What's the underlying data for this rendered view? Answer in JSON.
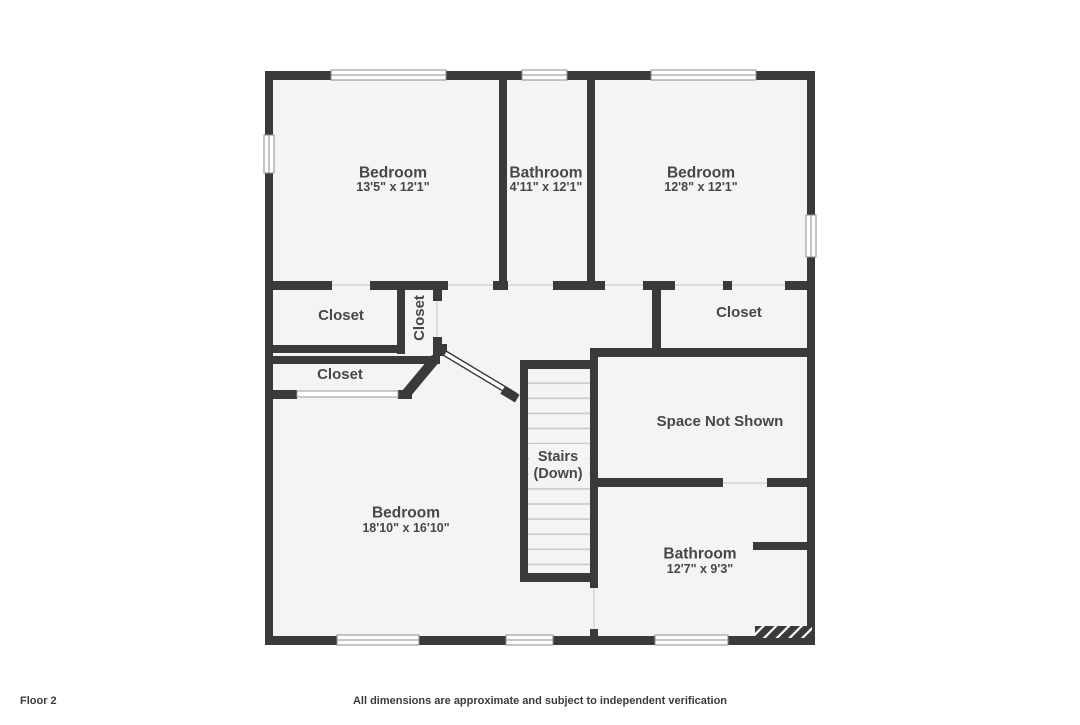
{
  "colors": {
    "wall": "#3a3a3c",
    "floor": "#f4f4f5",
    "text": "#47474a",
    "tread_line": "#c9c9cb",
    "window_border": "#8d8d8f",
    "background": "#ffffff"
  },
  "rooms": {
    "bedroom_top_left": {
      "name": "Bedroom",
      "dims": "13'5\" x 12'1\""
    },
    "bathroom_top": {
      "name": "Bathroom",
      "dims": "4'11\" x 12'1\""
    },
    "bedroom_top_right": {
      "name": "Bedroom",
      "dims": "12'8\" x 12'1\""
    },
    "closet_left": {
      "name": "Closet"
    },
    "closet_hall": {
      "name": "Closet"
    },
    "closet_right": {
      "name": "Closet"
    },
    "closet_lower_left": {
      "name": "Closet"
    },
    "space_not_shown": {
      "name": "Space Not Shown"
    },
    "stairs": {
      "line1": "Stairs",
      "line2": "(Down)"
    },
    "bedroom_large": {
      "name": "Bedroom",
      "dims": "18'10\" x 16'10\""
    },
    "bathroom_bottom": {
      "name": "Bathroom",
      "dims": "12'7\" x 9'3\""
    }
  },
  "footer": {
    "floor_label": "Floor 2",
    "disclaimer": "All dimensions are approximate and subject to independent verification"
  }
}
